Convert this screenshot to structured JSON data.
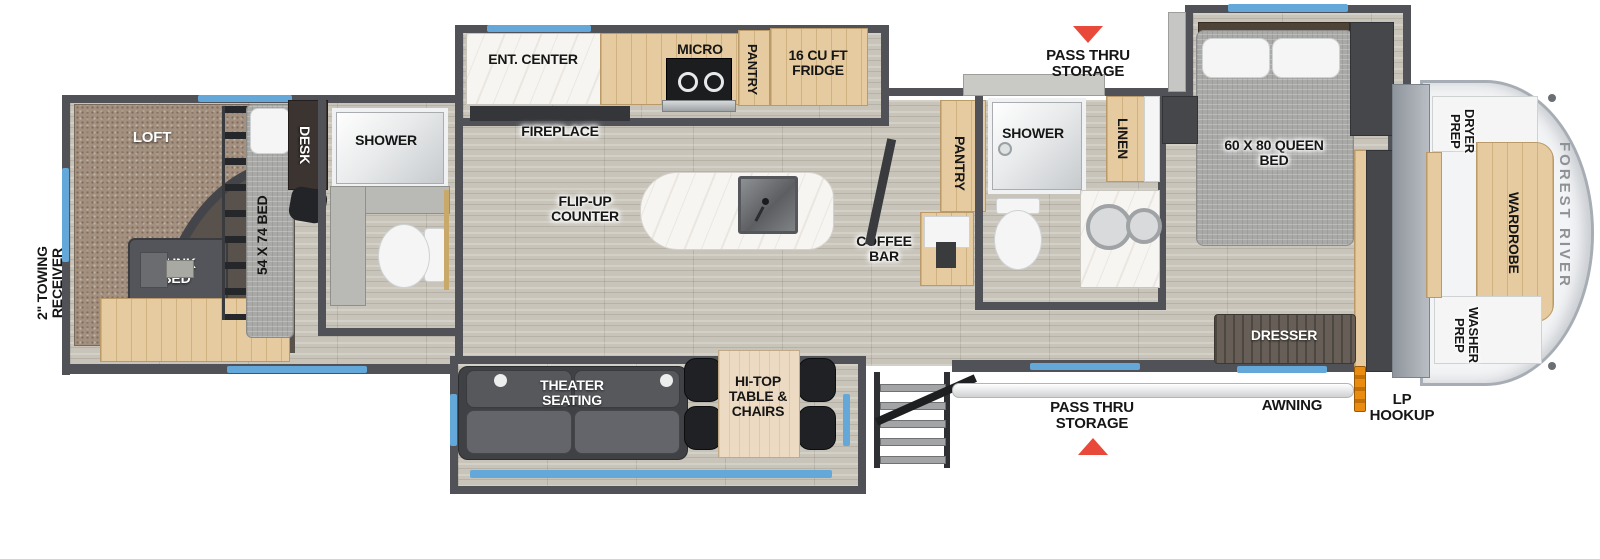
{
  "brand": "FOREST RIVER",
  "exterior": {
    "towing": "2\" TOWING RECEIVER",
    "pass_thru_top": "PASS THRU STORAGE",
    "pass_thru_bottom": "PASS THRU STORAGE",
    "awning": "AWNING",
    "lp": "LP HOOKUP"
  },
  "bunk_room": {
    "loft": "LOFT",
    "bunk_bed": "BUNK BED",
    "bed": "54 X 74 BED",
    "desk": "DESK",
    "shower": "SHOWER"
  },
  "kitchen": {
    "ent_center": "ENT. CENTER",
    "fireplace": "FIREPLACE",
    "micro": "MICRO",
    "pantry": "PANTRY",
    "fridge": "16 CU FT FRIDGE",
    "flip_up": "FLIP-UP COUNTER",
    "coffee_bar": "COFFEE BAR"
  },
  "living": {
    "theater": "THEATER SEATING",
    "hi_top": "HI-TOP TABLE & CHAIRS"
  },
  "bath": {
    "pantry": "PANTRY",
    "shower": "SHOWER",
    "linen": "LINEN"
  },
  "bedroom": {
    "queen_bed": "60 X 80 QUEEN BED",
    "dresser": "DRESSER"
  },
  "front": {
    "dryer": "DRYER PREP",
    "wardrobe": "WARDROBE",
    "washer": "WASHER PREP"
  },
  "colors": {
    "wall": "#515257",
    "floor": "#c8c4ba",
    "carpet": "#a3907f",
    "window_accent": "#64a7d9",
    "arrow_red": "#e8493b",
    "lp_orange": "#ea8c0f",
    "cabinet_tan": "#e5cb9f",
    "dark_furniture": "#46474b",
    "brand_gray": "#8e9296"
  }
}
